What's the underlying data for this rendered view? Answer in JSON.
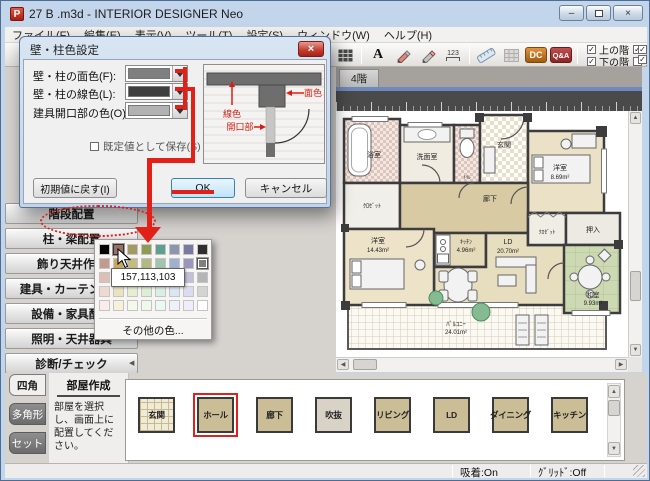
{
  "glyphs": {
    "up": "▲",
    "down": "▼",
    "left": "◀",
    "right": "▶",
    "check": "✓",
    "close": "×",
    "minimize": "–"
  },
  "window": {
    "title": "27 B .m3d - INTERIOR DESIGNER Neo"
  },
  "menu_bar": {
    "items": [
      "ファイル(F)",
      "編集(E)",
      "表示(V)",
      "ツール(T)",
      "設定(S)",
      "ウィンドウ(W)",
      "ヘルプ(H)"
    ]
  },
  "toolbar": {
    "text_tool": "A",
    "dim_tool": "123",
    "dc_badge": "DC",
    "qa_badge": "Q&A",
    "layer_checks": [
      {
        "label": "上の階",
        "checked": true
      },
      {
        "label": "下の階",
        "checked": true
      },
      {
        "label": "住宅設備",
        "checked": true
      },
      {
        "label": "天井",
        "checked": false
      }
    ]
  },
  "canvas": {
    "floor_tab": "4階"
  },
  "dialog": {
    "title": "壁・柱色設定",
    "fields": [
      {
        "label": "壁・柱の面色(F):",
        "color": "#7f7f7f"
      },
      {
        "label": "壁・柱の線色(L):",
        "color": "#3f3f3f"
      },
      {
        "label": "建具開口部の色(O):",
        "color": "#b2b2b2"
      }
    ],
    "save_default_label": "既定値として保存(S)",
    "reset_button": "初期値に戻す(I)",
    "ok_button": "OK",
    "cancel_button": "キャンセル",
    "preview_labels": {
      "line": "線色",
      "face": "面色",
      "opening": "開口部"
    }
  },
  "color_picker": {
    "tooltip": "157,113,103",
    "other_colors": "その他の色...",
    "hover_cell": [
      0,
      1
    ],
    "selected_cell": [
      1,
      7
    ],
    "swatches": [
      [
        "#000000",
        "#9a6f65",
        "#a29a62",
        "#8f9a55",
        "#5f9f90",
        "#8d95af",
        "#7c79a0",
        "#2f2f2f"
      ],
      [
        "#c49a90",
        "#c7a960",
        "#c2bb82",
        "#b3b983",
        "#a2c3ad",
        "#9eb1cf",
        "#9a96bc",
        "#808080"
      ],
      [
        "#dcc0b6",
        "#ddca9e",
        "#d9d6ae",
        "#cbd7ae",
        "#c6dbcf",
        "#c3cfe3",
        "#c3bfdb",
        "#b5b5b5"
      ],
      [
        "#efd9d3",
        "#ece2c2",
        "#e7edcf",
        "#ddefd3",
        "#d9efe5",
        "#dbe5f3",
        "#dddbef",
        "#d4d4d4"
      ],
      [
        "#f9edeb",
        "#f7f1da",
        "#f5f9e7",
        "#edf9eb",
        "#ebf9f3",
        "#edf1f9",
        "#efedf9",
        "#ffffff"
      ]
    ]
  },
  "sidebar": {
    "items": [
      "階段配置",
      "柱・梁配置",
      "飾り天井作成",
      "建具・カーテン配置",
      "設備・家具配置",
      "照明・天井器具",
      "診断/チェック"
    ],
    "tabs": [
      {
        "label": "四角",
        "active": true
      },
      {
        "label": "多角形",
        "active": false
      },
      {
        "label": "セット",
        "active": false
      }
    ]
  },
  "room_creation": {
    "title": "部屋作成",
    "instruction": "部屋を選択し、画面上に配置してください。"
  },
  "room_palette": {
    "buttons": [
      {
        "label": "玄関",
        "style": "grid"
      },
      {
        "label": "ホール",
        "selected": true
      },
      {
        "label": "廊下"
      },
      {
        "label": "吹抜",
        "style": "light"
      },
      {
        "label": "リビング"
      },
      {
        "label": "LD"
      },
      {
        "label": "ダイニング"
      },
      {
        "label": "キッチン"
      }
    ]
  },
  "status_bar": {
    "snap": "吸着:On",
    "grid": "ｸﾞﾘｯﾄﾞ:Off"
  },
  "floor_plan": {
    "labels": {
      "bath": "浴室",
      "wash": "洗面室",
      "toilet": "ﾄｲﾚ",
      "entrance": "玄関",
      "corridor": "廊下",
      "closet_left": "ｸﾛｾﾞｯﾄ",
      "closet_right": "ｸﾛｾﾞｯﾄ",
      "oshiire": "押入",
      "bed1_name": "洋室",
      "bed1_area": "8.69m²",
      "bed2_name": "洋室",
      "bed2_area": "14.43m²",
      "kitchen_name": "ｷｯﾁﾝ",
      "kitchen_area": "4.96m²",
      "ld_name": "LD",
      "ld_area": "20.70m²",
      "washitsu_name": "和室",
      "washitsu_area": "9.93m²",
      "balcony_name": "ﾊﾞﾙｺﾆｰ",
      "balcony_area": "24.01m²"
    }
  }
}
